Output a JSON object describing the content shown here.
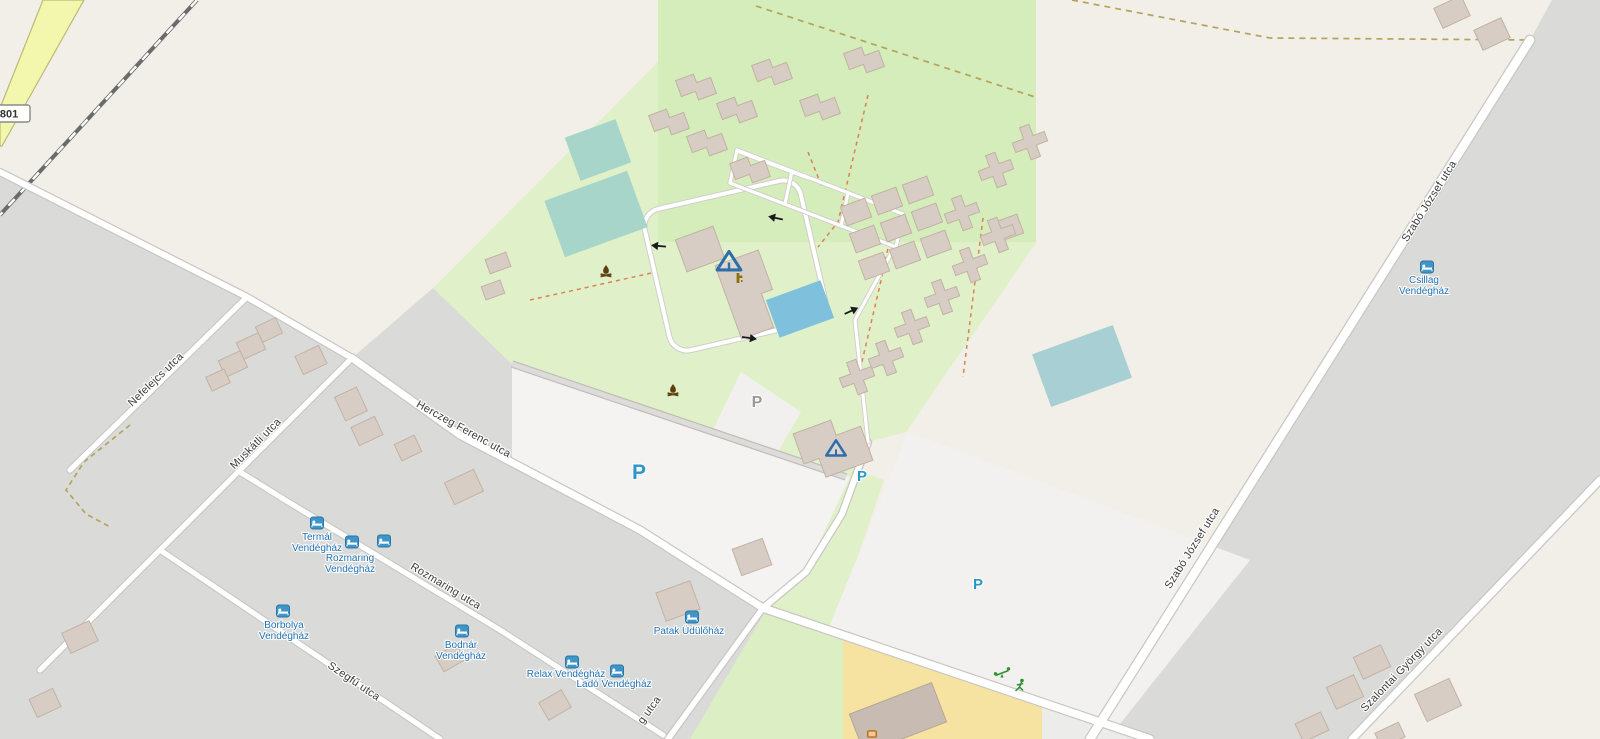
{
  "map": {
    "road_badge": {
      "ref": "801"
    },
    "streets": [
      {
        "id": "nefelejcs-utca",
        "name": "Nefelejcs utca",
        "x": 158,
        "y": 382,
        "rot": -44
      },
      {
        "id": "muskatli-utca",
        "name": "Muskátli utca",
        "x": 258,
        "y": 446,
        "rot": -45
      },
      {
        "id": "herczeg-ferenc-utca",
        "name": "Herczeg Ferenc utca",
        "x": 462,
        "y": 432,
        "rot": 29
      },
      {
        "id": "rozmaring-utca",
        "name": "Rozmaring utca",
        "x": 444,
        "y": 589,
        "rot": 31
      },
      {
        "id": "szegfu-utca",
        "name": "Szegfű utca",
        "x": 352,
        "y": 684,
        "rot": 34
      },
      {
        "id": "g-utca-partial",
        "name": "g utca",
        "x": 652,
        "y": 712,
        "rot": -54
      },
      {
        "id": "szabo-jozsef-utca-south",
        "name": "Szabó József utca",
        "x": 1195,
        "y": 550,
        "rot": -58
      },
      {
        "id": "szabo-jozsef-utca-north",
        "name": "Szabó József utca",
        "x": 1432,
        "y": 203,
        "rot": -58
      },
      {
        "id": "szalontai-gyorgy-utca",
        "name": "Szalontai György utca",
        "x": 1404,
        "y": 672,
        "rot": -46
      }
    ],
    "places": [
      {
        "id": "termal-vendeghaz",
        "name": "Termál Vendégház",
        "lines": [
          "Termál",
          "Vendégház"
        ],
        "icon_x": 317,
        "icon_y": 523,
        "label_x": 317,
        "label_y": 540
      },
      {
        "id": "rozmaring-vendeghaz",
        "name": "Rozmaring Vendégház",
        "lines": [
          "Rozmaring",
          "Vendégház"
        ],
        "icon_x": 352,
        "icon_y": 542,
        "label_x": 350,
        "label_y": 561
      },
      {
        "id": "borbolya-vendeghaz",
        "name": "Borbolya Vendégház",
        "lines": [
          "Borbolya",
          "Vendégház"
        ],
        "icon_x": 283,
        "icon_y": 611,
        "label_x": 284,
        "label_y": 628
      },
      {
        "id": "bodnar-vendeghaz",
        "name": "Bodnár Vendégház",
        "lines": [
          "Bodnár",
          "Vendégház"
        ],
        "icon_x": 462,
        "icon_y": 631,
        "label_x": 461,
        "label_y": 648
      },
      {
        "id": "relax-vendeghaz",
        "name": "Relax Vendégház",
        "lines": [
          "Relax Vendégház"
        ],
        "icon_x": 572,
        "icon_y": 662,
        "label_x": 566,
        "label_y": 677
      },
      {
        "id": "lado-vendeghaz",
        "name": "Ladó Vendégház",
        "lines": [
          "Ladó Vendégház"
        ],
        "icon_x": 617,
        "icon_y": 671,
        "label_x": 614,
        "label_y": 687
      },
      {
        "id": "patak-udulohaz",
        "name": "Patak Üdülőház",
        "lines": [
          "Patak Üdülőház"
        ],
        "icon_x": 692,
        "icon_y": 617,
        "label_x": 689,
        "label_y": 634
      },
      {
        "id": "csillag-vendeghaz",
        "name": "Csillag Vendégház",
        "lines": [
          "Csillag",
          "Vendégház"
        ],
        "icon_x": 1427,
        "icon_y": 267,
        "label_x": 1424,
        "label_y": 283
      }
    ],
    "extra_lodging_icons": [
      {
        "x": 384,
        "y": 541
      }
    ],
    "parking_markers": [
      {
        "x": 639,
        "y": 479,
        "color": "blue",
        "size": 21
      },
      {
        "x": 862,
        "y": 481,
        "color": "blue",
        "size": 15
      },
      {
        "x": 978,
        "y": 589,
        "color": "blue",
        "size": 15
      },
      {
        "x": 757,
        "y": 407,
        "color": "gray",
        "size": 16
      }
    ],
    "amenity_icons": [
      {
        "type": "campsite-tent",
        "x": 729,
        "y": 262,
        "size": 22
      },
      {
        "type": "campsite-tent",
        "x": 836,
        "y": 449,
        "size": 18
      },
      {
        "type": "campfire",
        "x": 606,
        "y": 272,
        "size": 1
      },
      {
        "type": "campfire",
        "x": 673,
        "y": 391,
        "size": 1
      },
      {
        "type": "drinking-water",
        "x": 738,
        "y": 278,
        "size": 1
      },
      {
        "type": "playground-seesaw",
        "x": 1002,
        "y": 673,
        "size": 1
      },
      {
        "type": "fitness-runner",
        "x": 1020,
        "y": 686,
        "size": 1
      },
      {
        "type": "picnic-bench",
        "x": 872,
        "y": 734,
        "size": 1
      }
    ],
    "oneway_arrows": [
      {
        "x": 659,
        "y": 246,
        "rot": 185
      },
      {
        "x": 776,
        "y": 218,
        "rot": 192
      },
      {
        "x": 749,
        "y": 338,
        "rot": 8
      },
      {
        "x": 851,
        "y": 311,
        "rot": -25
      }
    ],
    "colors": {
      "residential_gray": "#dadad8",
      "field_cream": "#f2efe9",
      "grass_green": "#e0f1ca",
      "grass_inner_green": "#d5edba",
      "pool_teal": "#a8d5ca",
      "pool_blue": "#7fc1dd",
      "building_tan": "#d7cdc5",
      "school_yellow": "#f6e3a1",
      "road_yellow": "#f3f6ad",
      "poi_label_blue": "#1f6fb2",
      "parking_blue": "#2b96c8",
      "parking_gray": "#9b9997",
      "street_label_gray": "#3a3a3a",
      "fence_dash_orange": "#e07e58",
      "boundary_dash_tan": "#b3a45c",
      "playground_green": "#2f8f2f",
      "campfire_brown": "#5f3f12"
    }
  }
}
